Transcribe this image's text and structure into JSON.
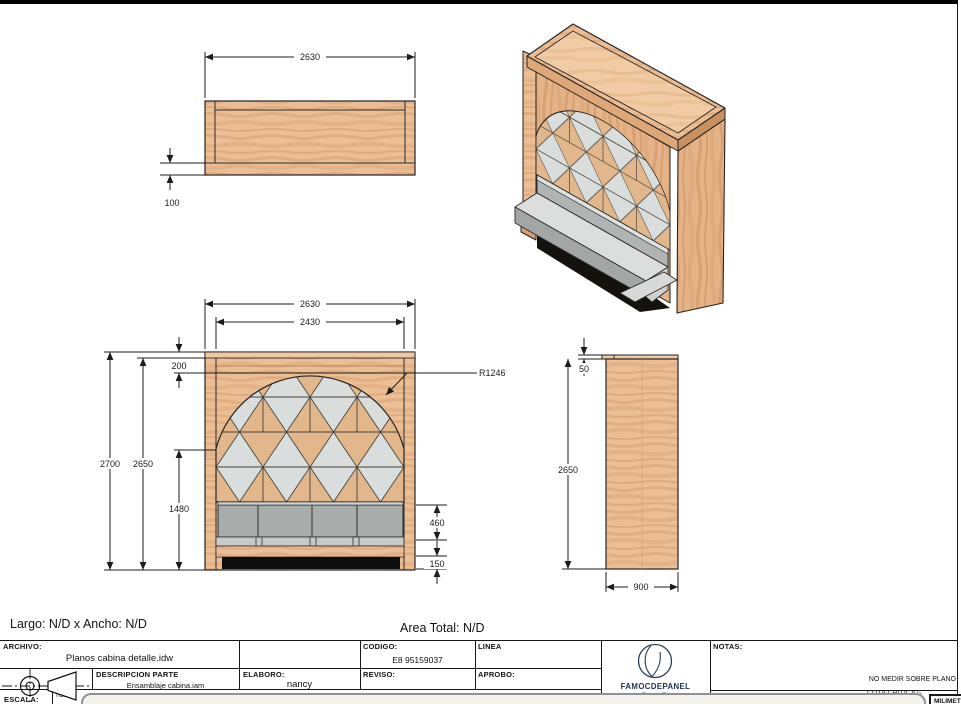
{
  "summary": {
    "largo_ancho": "Largo: N/D x Ancho: N/D",
    "area_total": "Area Total: N/D"
  },
  "views": {
    "top": {
      "dims": {
        "width": "2630",
        "front_thickness": "100"
      }
    },
    "front": {
      "dims": {
        "width": "2630",
        "inner_width": "2430",
        "top_offset": "200",
        "total_height": "2700",
        "inner_height": "2650",
        "bench_top_height": "1480",
        "arch_radius": "R1246",
        "seat_back_height": "460",
        "base_height": "150"
      }
    },
    "side": {
      "dims": {
        "top_lip": "50",
        "height": "2650",
        "depth": "900"
      }
    }
  },
  "title_block": {
    "archivo_label": "ARCHIVO:",
    "archivo_value": "Planos cabina detalle.idw",
    "codigo_label": "CODIGO:",
    "codigo_value": "E8 95159037",
    "linea_label": "LINEA",
    "descripcion_label": "DESCRIPCION PARTE",
    "descripcion_value": "Ensamblaje cabina.iam",
    "elaboro_label": "ELABORO:",
    "elaboro_value": "nancy",
    "reviso_label": "REVISO:",
    "aprobo_label": "APROBO:",
    "notas_label": "NOTAS:",
    "nota_1": "NO MEDIR SOBRE PLANO",
    "nota_2": "COTA CRITICA",
    "escala_label": "ESCALA:",
    "toler_label": "TOLER",
    "units": "MILIMETROS",
    "brand": "FAMOCDEPANEL"
  },
  "colors": {
    "wood": "#ecbe94",
    "wood_dark": "#d9a173",
    "wood_light": "#f1cba3",
    "lattice_gray": "#d9dddc",
    "bench_gray": "#a8acab",
    "brand_navy": "#20334f"
  }
}
